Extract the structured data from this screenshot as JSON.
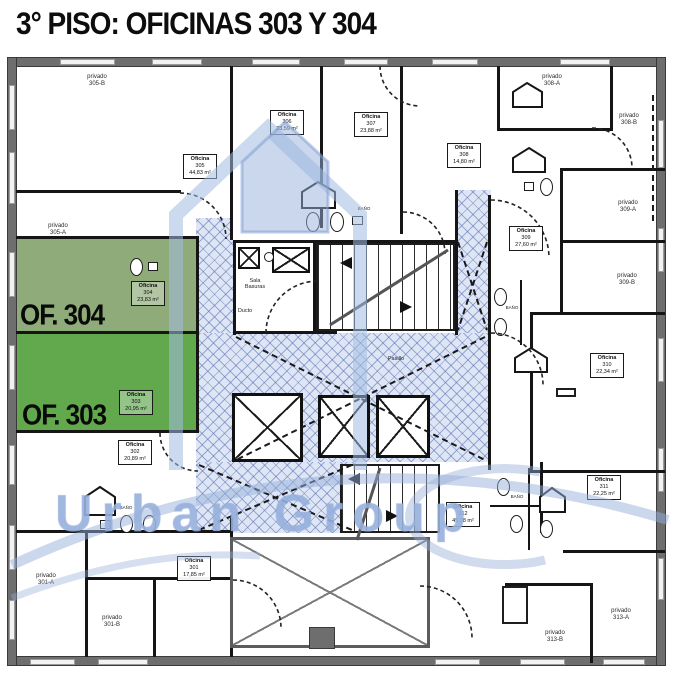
{
  "title": "3° PISO: OFICINAS 303 Y 304",
  "watermark": {
    "text": "Urban Group"
  },
  "highlights": {
    "of304": "OF. 304",
    "of303": "OF. 303"
  },
  "office_labels": [
    {
      "title": "Oficina",
      "num": "305",
      "area": "44,83 m²"
    },
    {
      "title": "Oficina",
      "num": "306",
      "area": "23,59 m²"
    },
    {
      "title": "Oficina",
      "num": "307",
      "area": "23,88 m²"
    },
    {
      "title": "Oficina",
      "num": "308",
      "area": "14,80 m²"
    },
    {
      "title": "Oficina",
      "num": "309",
      "area": "27,60 m²"
    },
    {
      "title": "Oficina",
      "num": "310",
      "area": "22,34 m²"
    },
    {
      "title": "Oficina",
      "num": "304",
      "area": "23,83 m²"
    },
    {
      "title": "Oficina",
      "num": "303",
      "area": "20,95 m²"
    },
    {
      "title": "Oficina",
      "num": "302",
      "area": "20,89 m²"
    },
    {
      "title": "Oficina",
      "num": "301",
      "area": "17,85 m²"
    },
    {
      "title": "Oficina",
      "num": "311",
      "area": "22,25 m²"
    },
    {
      "title": "Oficina",
      "num": "312",
      "area": "45,18 m²"
    }
  ],
  "private_labels": [
    {
      "line1": "privado",
      "line2": "305-B"
    },
    {
      "line1": "privado",
      "line2": "305-A"
    },
    {
      "line1": "privado",
      "line2": "308-A"
    },
    {
      "line1": "privado",
      "line2": "308-B"
    },
    {
      "line1": "privado",
      "line2": "309-A"
    },
    {
      "line1": "privado",
      "line2": "309-B"
    },
    {
      "line1": "privado",
      "line2": "301-A"
    },
    {
      "line1": "privado",
      "line2": "301-B"
    },
    {
      "line1": "privado",
      "line2": "313-A"
    },
    {
      "line1": "privado",
      "line2": "313-B"
    }
  ],
  "core_labels": {
    "sala_line1": "Sala",
    "sala_line2": "Basuras",
    "ducto": "Ducto",
    "pasillo": "Pasillo",
    "bano": "BAÑO"
  },
  "colors": {
    "highlight_304": "#8aa878",
    "highlight_303": "#55a23f",
    "circulation_hatch": "#c9d6f0",
    "outer_wall": "#6e6e6e",
    "watermark_blue": "#a0b8e0",
    "title_color": "#0d0d0d"
  }
}
